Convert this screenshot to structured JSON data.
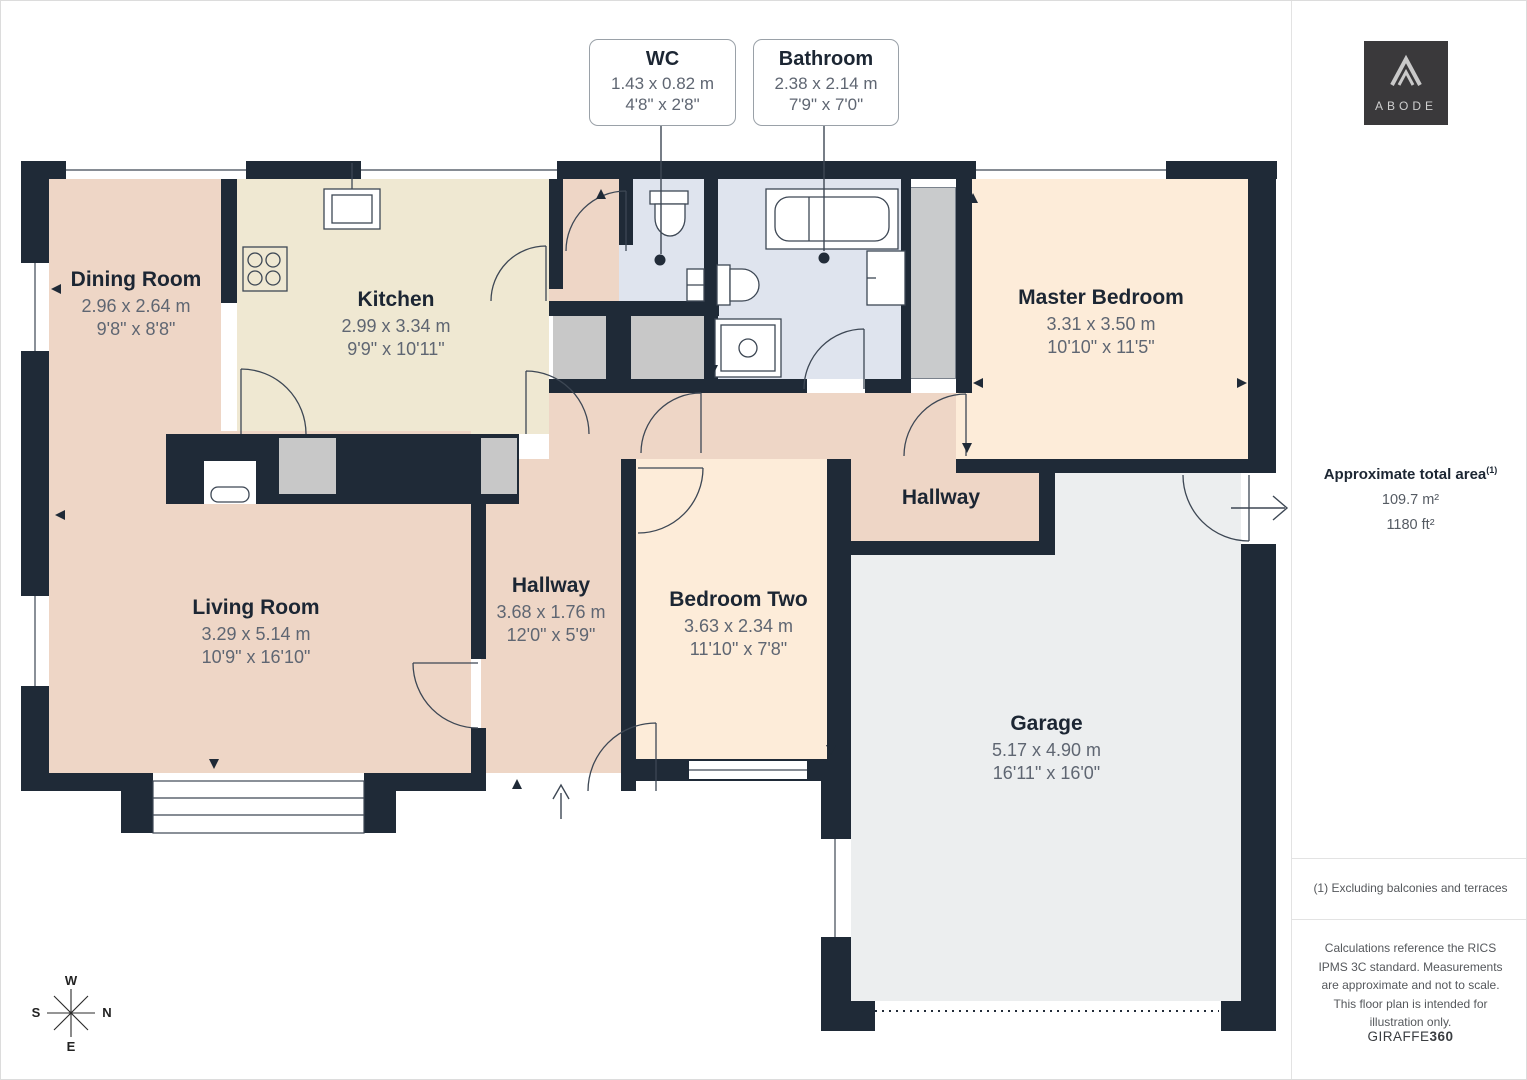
{
  "colors": {
    "wall": "#1f2a37",
    "room_salmon": "#eed6c6",
    "room_cream": "#efe8d2",
    "room_peach": "#fdecd9",
    "room_blue": "#dfe4ee",
    "room_garage": "#eceeef",
    "storage_gray": "#c8c8c8",
    "logo_bg": "#3a393b"
  },
  "plan": {
    "rooms": [
      {
        "name": "Dining Room",
        "dim_m": "2.96 x 2.64 m",
        "dim_ft": "9'8\" x 8'8\""
      },
      {
        "name": "Kitchen",
        "dim_m": "2.99 x 3.34 m",
        "dim_ft": "9'9\" x 10'11\""
      },
      {
        "name": "Living Room",
        "dim_m": "3.29 x 5.14 m",
        "dim_ft": "10'9\" x 16'10\""
      },
      {
        "name": "Hallway",
        "dim_m": "3.68 x 1.76 m",
        "dim_ft": "12'0\" x 5'9\""
      },
      {
        "name": "Bedroom Two",
        "dim_m": "3.63 x 2.34 m",
        "dim_ft": "11'10\" x 7'8\""
      },
      {
        "name": "Master Bedroom",
        "dim_m": "3.31 x 3.50 m",
        "dim_ft": "10'10\" x 11'5\""
      },
      {
        "name": "Hallway"
      },
      {
        "name": "Garage",
        "dim_m": "5.17 x 4.90 m",
        "dim_ft": "16'11\" x 16'0\""
      }
    ],
    "callouts": [
      {
        "name": "WC",
        "dim_m": "1.43 x 0.82 m",
        "dim_ft": "4'8\" x 2'8\""
      },
      {
        "name": "Bathroom",
        "dim_m": "2.38 x 2.14 m",
        "dim_ft": "7'9\" x 7'0\""
      }
    ],
    "compass": {
      "top": "W",
      "right": "N",
      "bottom": "E",
      "left": "S"
    }
  },
  "sidebar": {
    "logo_text": "ABODE",
    "area_title": "Approximate total area",
    "area_superscript": "(1)",
    "area_m2": "109.7 m²",
    "area_ft2": "1180 ft²",
    "footnote": "(1) Excluding balconies and terraces",
    "disclaimer": "Calculations reference the RICS IPMS 3C standard. Measurements are approximate and not to scale. This floor plan is intended for illustration only.",
    "brand_left": "GIRAFFE",
    "brand_right": "360"
  }
}
